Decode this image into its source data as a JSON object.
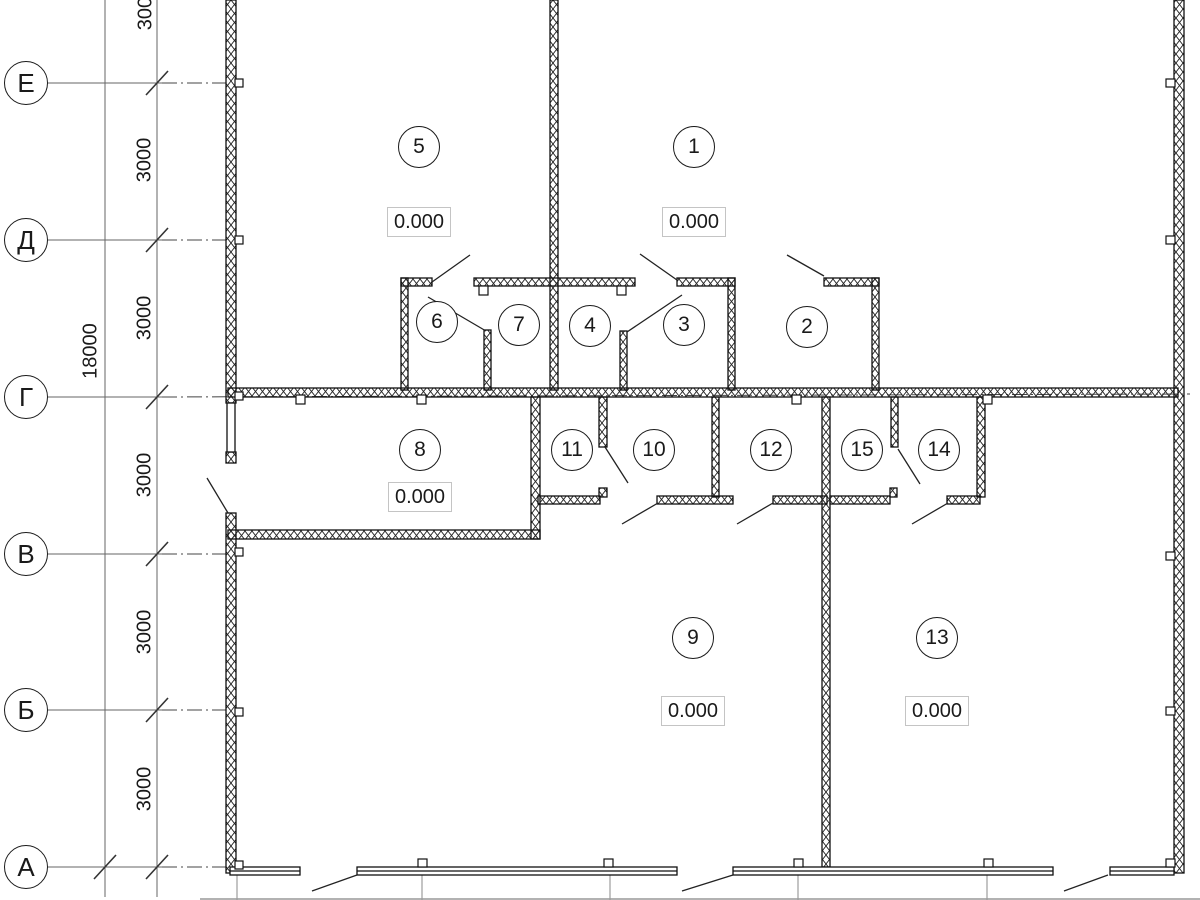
{
  "drawing": {
    "type_label": "floor-plan",
    "colors": {
      "wall_line": "#1a1a1a",
      "dimension_line": "#666666",
      "axis_dashdot": "#444444",
      "background": "#ffffff"
    }
  },
  "axes": {
    "rows": [
      {
        "label": "Е"
      },
      {
        "label": "Д"
      },
      {
        "label": "Г"
      },
      {
        "label": "В"
      },
      {
        "label": "Б"
      },
      {
        "label": "А"
      }
    ]
  },
  "dims": {
    "overall": "18000",
    "interval": "3000"
  },
  "rooms": [
    {
      "number": "1",
      "elevation": "0.000"
    },
    {
      "number": "2"
    },
    {
      "number": "3"
    },
    {
      "number": "4"
    },
    {
      "number": "5",
      "elevation": "0.000"
    },
    {
      "number": "6"
    },
    {
      "number": "7"
    },
    {
      "number": "8",
      "elevation": "0.000"
    },
    {
      "number": "9",
      "elevation": "0.000"
    },
    {
      "number": "10"
    },
    {
      "number": "11"
    },
    {
      "number": "12"
    },
    {
      "number": "13",
      "elevation": "0.000"
    },
    {
      "number": "14"
    },
    {
      "number": "15"
    }
  ]
}
